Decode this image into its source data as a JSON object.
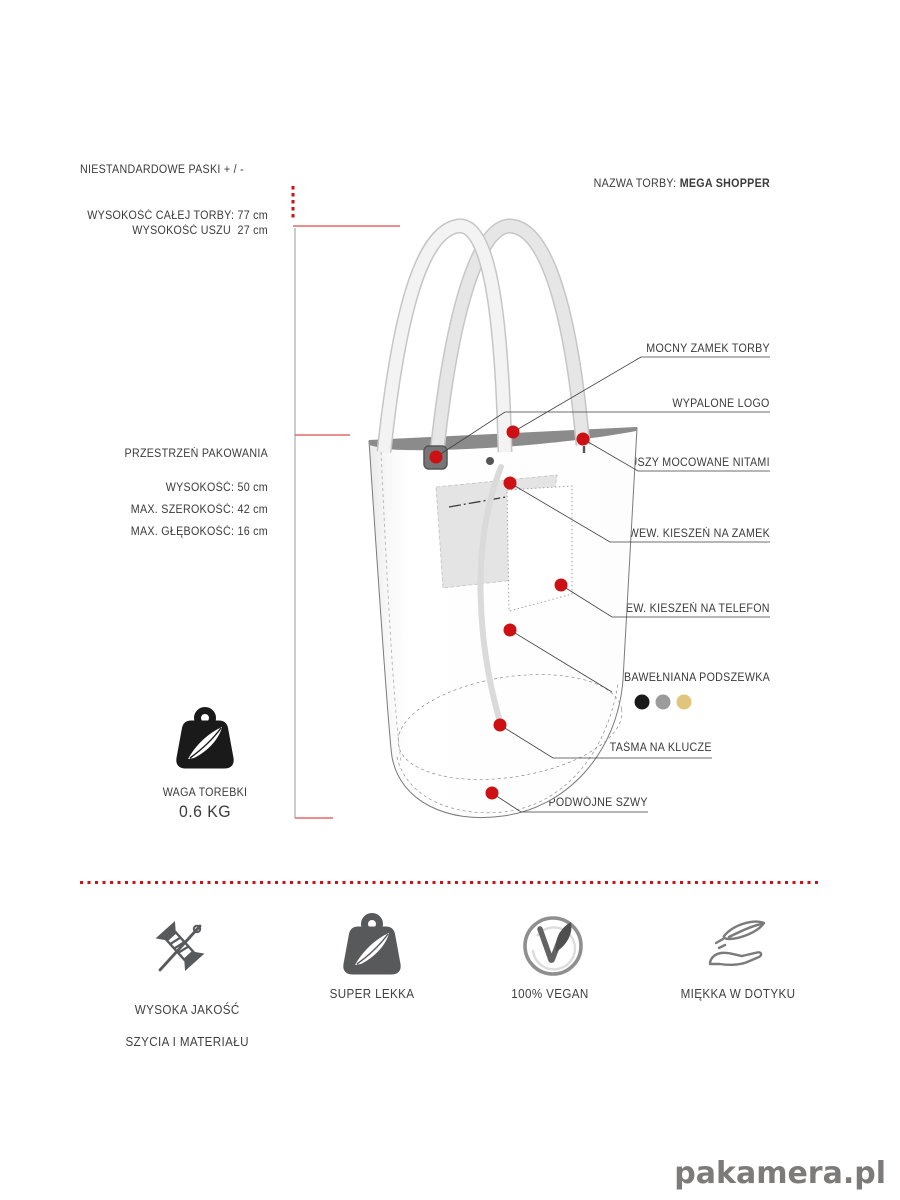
{
  "header": {
    "custom_straps_label": "NIESTANDARDOWE PASKI + / -",
    "bag_name_label": "NAZWA TORBY: ",
    "bag_name": "MEGA SHOPPER"
  },
  "dimensions": {
    "total_height": "WYSOKOŚĆ CAŁEJ TORBY: 77 cm",
    "handle_height": "WYSOKOŚĆ USZU  27 cm",
    "packing_space_title": "PRZESTRZEŃ PAKOWANIA",
    "height": "WYSOKOŚĆ: 50 cm",
    "max_width": "MAX. SZEROKOŚĆ: 42 cm",
    "max_depth": "MAX. GŁĘBOKOŚĆ: 16 cm"
  },
  "weight": {
    "label": "WAGA TOREBKI",
    "value": "0.6 KG"
  },
  "callouts": {
    "zipper": "MOCNY ZAMEK TORBY",
    "logo": "WYPALONE LOGO",
    "rivets": "USZY MOCOWANE NITAMI",
    "zip_pocket": "WEW. KIESZEŃ NA ZAMEK",
    "phone_pocket": "WEW. KIESZEŃ NA TELEFON",
    "lining": "BAWEŁNIANA PODSZEWKA",
    "key_strap": "TAŚMA NA KLUCZE",
    "double_seams": "PODWÓJNE SZWY"
  },
  "lining_colors": {
    "black": "#1a1a1a",
    "gray": "#9b9b9b",
    "beige": "#e2c57c"
  },
  "features": {
    "quality": {
      "line1": "WYSOKA JAKOŚĆ",
      "line2": "SZYCIA I MATERIAŁU"
    },
    "light": {
      "line1": "SUPER LEKKA"
    },
    "vegan": {
      "line1": "100% VEGAN"
    },
    "soft": {
      "line1": "MIĘKKA W DOTYKU"
    }
  },
  "colors": {
    "accent_red": "#cc1013",
    "measure_red": "#e04a4a",
    "ink": "#3b3b3b",
    "icon_gray": "#58595b"
  },
  "brand": {
    "logo_text": "pakamera.pl"
  }
}
